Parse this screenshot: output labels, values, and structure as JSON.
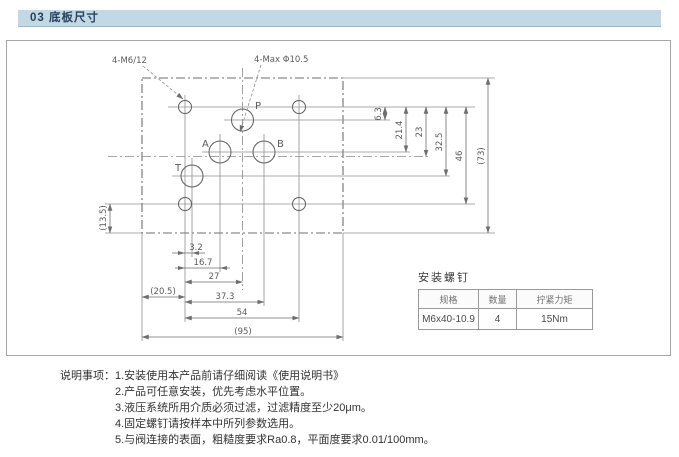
{
  "page": {
    "title_bar": "03 底板尺寸"
  },
  "drawing": {
    "callout_threads": "4-M6/12",
    "callout_ports": "4-Max Φ10.5",
    "ports": {
      "p": "P",
      "a": "A",
      "b": "B",
      "t": "T"
    },
    "dims": {
      "h_3_2": "3.2",
      "h_16_7": "16.7",
      "h_27": "27",
      "h_20_5": "(20.5)",
      "h_37_3": "37.3",
      "h_54": "54",
      "h_95": "(95)",
      "v_6_3": "6.3",
      "v_21_4": "21.4",
      "v_23": "23",
      "v_32_5": "32.5",
      "v_46": "46",
      "v_73": "(73)",
      "v_13_5": "(13.5)"
    }
  },
  "screws_table": {
    "title": "安装螺钉",
    "headers": [
      "规格",
      "数量",
      "拧紧力矩"
    ],
    "row": [
      "M6x40-10.9",
      "4",
      "15Nm"
    ]
  },
  "notes": {
    "label": "说明事项：",
    "items": [
      "1.安装使用本产品前请仔细阅读《使用说明书》",
      "2.产品可任意安装，优先考虑水平位置。",
      "3.液压系统所用介质必须过滤，过滤精度至少20μm。",
      "4.固定螺钉请按样本中所列参数选用。",
      "5.与阀连接的表面，粗糙度要求Ra0.8，平面度要求0.01/100mm。"
    ]
  }
}
